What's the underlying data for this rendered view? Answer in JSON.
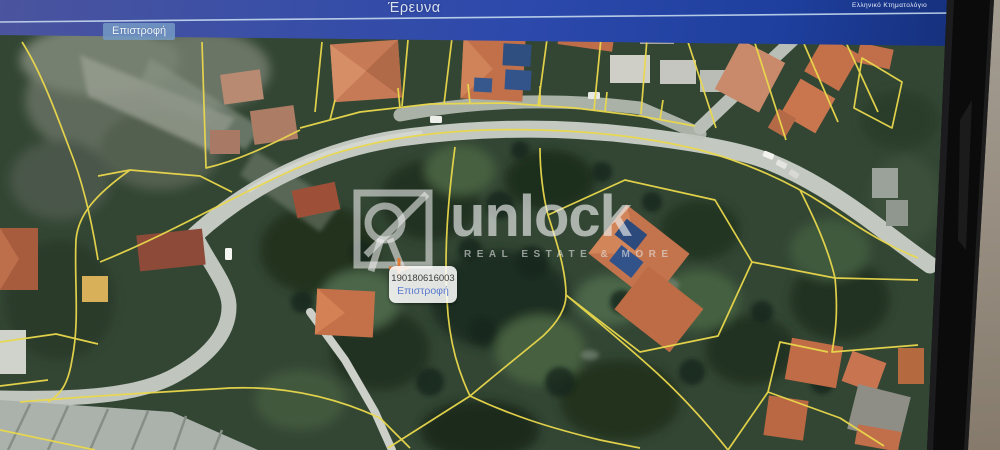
{
  "header": {
    "title": "Έρευνα",
    "brand": "Ελληνικό Κτηματολόγιο",
    "back_button_label": "Επιστροφή",
    "bg_color": "#2c49ab",
    "accent_line_color": "#cfe2f2"
  },
  "map": {
    "type": "satellite-cadastral-view",
    "parcel_line_color": "#ead84c",
    "popup": {
      "parcel_code": "190180616003",
      "link_label": "Επιστροφή"
    },
    "marker_color": "#e07b35",
    "watermark": {
      "name": "unlock",
      "tagline": "REAL ESTATE & MORE"
    }
  }
}
